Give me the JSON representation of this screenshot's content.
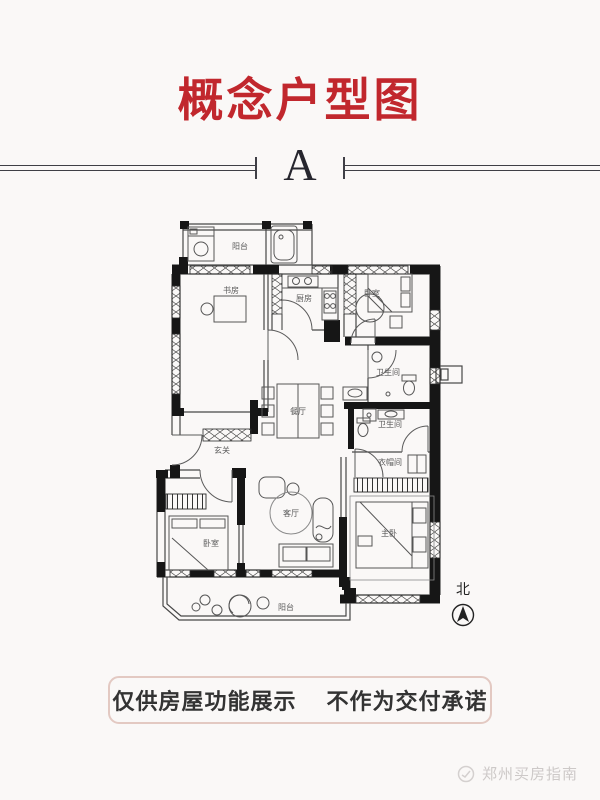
{
  "title": {
    "text": "概念户型图",
    "color": "#c1272d"
  },
  "unit": {
    "label": "A"
  },
  "plan": {
    "rooms": [
      {
        "id": "balcony-top",
        "label": "阳台"
      },
      {
        "id": "study",
        "label": "书房"
      },
      {
        "id": "kitchen",
        "label": "厨房"
      },
      {
        "id": "bedroom-north",
        "label": "卧室"
      },
      {
        "id": "bath-north",
        "label": "卫生间"
      },
      {
        "id": "bath-south",
        "label": "卫生间"
      },
      {
        "id": "cloakroom",
        "label": "衣帽间"
      },
      {
        "id": "dining",
        "label": "餐厅"
      },
      {
        "id": "foyer",
        "label": "玄关"
      },
      {
        "id": "living",
        "label": "客厅"
      },
      {
        "id": "master-bedroom",
        "label": "主卧"
      },
      {
        "id": "bedroom-south",
        "label": "卧室"
      },
      {
        "id": "balcony-south",
        "label": "阳台"
      }
    ],
    "compass": {
      "north": "北"
    },
    "colors": {
      "wall": "#161616",
      "line": "#474747",
      "label": "#5a5a5a"
    }
  },
  "disclaimer": {
    "part1": "仅供房屋功能展示",
    "part2": "不作为交付承诺",
    "border_color": "#e3c9c2"
  },
  "watermark": {
    "text": "郑州买房指南"
  }
}
